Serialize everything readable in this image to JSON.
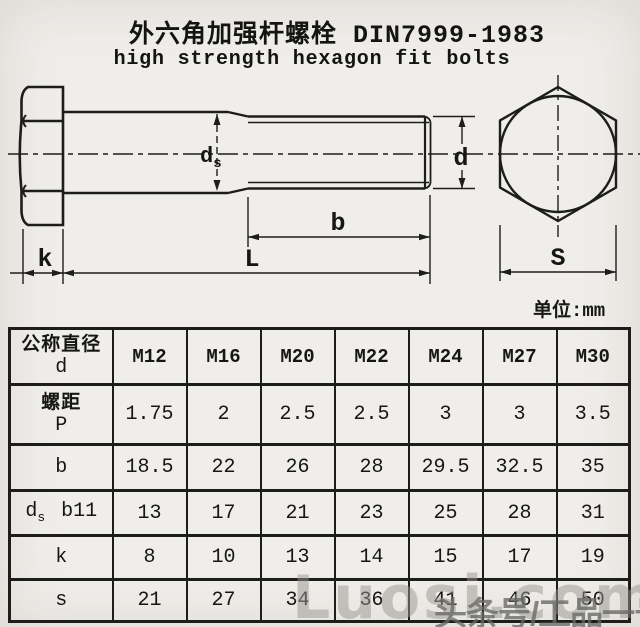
{
  "title": {
    "line1": "外六角加强杆螺栓 DIN7999-1983",
    "line2": "high strength hexagon fit bolts"
  },
  "drawing": {
    "unit_note": "单位:mm",
    "labels": {
      "shank_dia_main": "d",
      "shank_dia_sub": "s",
      "thread_dia": "d",
      "thread_length": "b",
      "total_length": "L",
      "head_height": "k",
      "width_across_flats": "S"
    }
  },
  "table": {
    "header": {
      "label_line1": "公称直径",
      "label_line2": "d",
      "columns": [
        "M12",
        "M16",
        "M20",
        "M22",
        "M24",
        "M27",
        "M30"
      ]
    },
    "rows": [
      {
        "name": "pitch",
        "label_line1": "螺距",
        "label_line2": "P",
        "values": [
          "1.75",
          "2",
          "2.5",
          "2.5",
          "3",
          "3",
          "3.5"
        ]
      },
      {
        "name": "thread-length",
        "label": "b",
        "values": [
          "18.5",
          "22",
          "26",
          "28",
          "29.5",
          "32.5",
          "35"
        ]
      },
      {
        "name": "shank-diameter",
        "label_main": "d",
        "label_sub": "s",
        "label_tol": "b11",
        "values": [
          "13",
          "17",
          "21",
          "23",
          "25",
          "28",
          "31"
        ]
      },
      {
        "name": "head-height",
        "label": "k",
        "values": [
          "8",
          "10",
          "13",
          "14",
          "15",
          "17",
          "19"
        ]
      },
      {
        "name": "width-across-flats",
        "label": "s",
        "values": [
          "21",
          "27",
          "34",
          "36",
          "41",
          "46",
          "50"
        ]
      }
    ]
  },
  "watermarks": {
    "light": "Luosi.com",
    "dark": "头条号/工品一号"
  },
  "colors": {
    "paper": "#f0eeea",
    "line": "#1d1d1b",
    "watermark_light": "#989690",
    "watermark_dark": "#68685f"
  }
}
